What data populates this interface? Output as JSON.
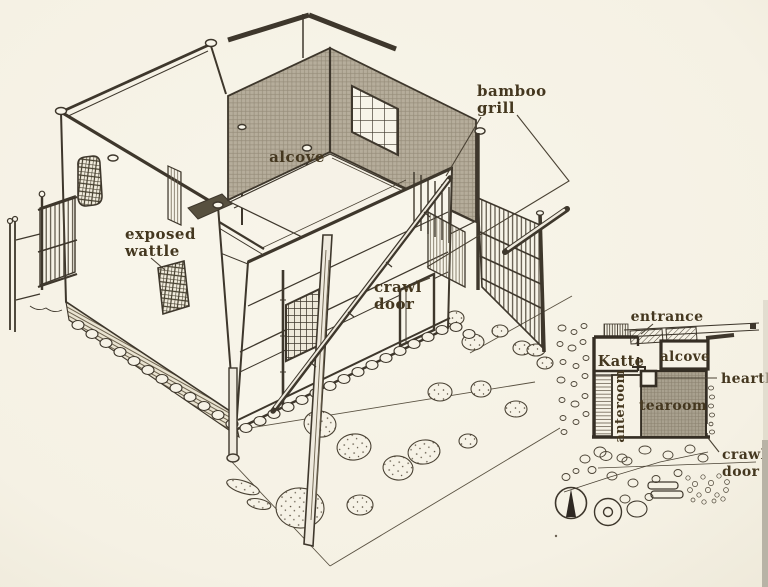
{
  "figure": {
    "kind": "book illustration",
    "subject": "Japanese teahouse: axonometric cutaway drawing with floor-plan inset"
  },
  "labels": {
    "main": {
      "bamboo_grill_1": "bamboo",
      "bamboo_grill_2": "grill",
      "alcove": "alcove",
      "exposed_wattle_1": "exposed",
      "exposed_wattle_2": "wattle",
      "crawl_door_1": "crawl",
      "crawl_door_2": "door"
    },
    "plan": {
      "entrance": "entrance",
      "katte": "Katte",
      "alcove": "alcove",
      "hearth": "hearth",
      "anteroom": "anteroom",
      "tearoom": "tearoom",
      "crawl_door_1": "crawl",
      "crawl_door_2": "door"
    }
  },
  "colors": {
    "paper": "#f5f1e4",
    "ink": "#3e372c",
    "shaded_wall": "#b6ad9b",
    "plan_room_shade": "#a9a18f",
    "label_text": "#44371f",
    "page_edge": "#b8b3a6"
  }
}
